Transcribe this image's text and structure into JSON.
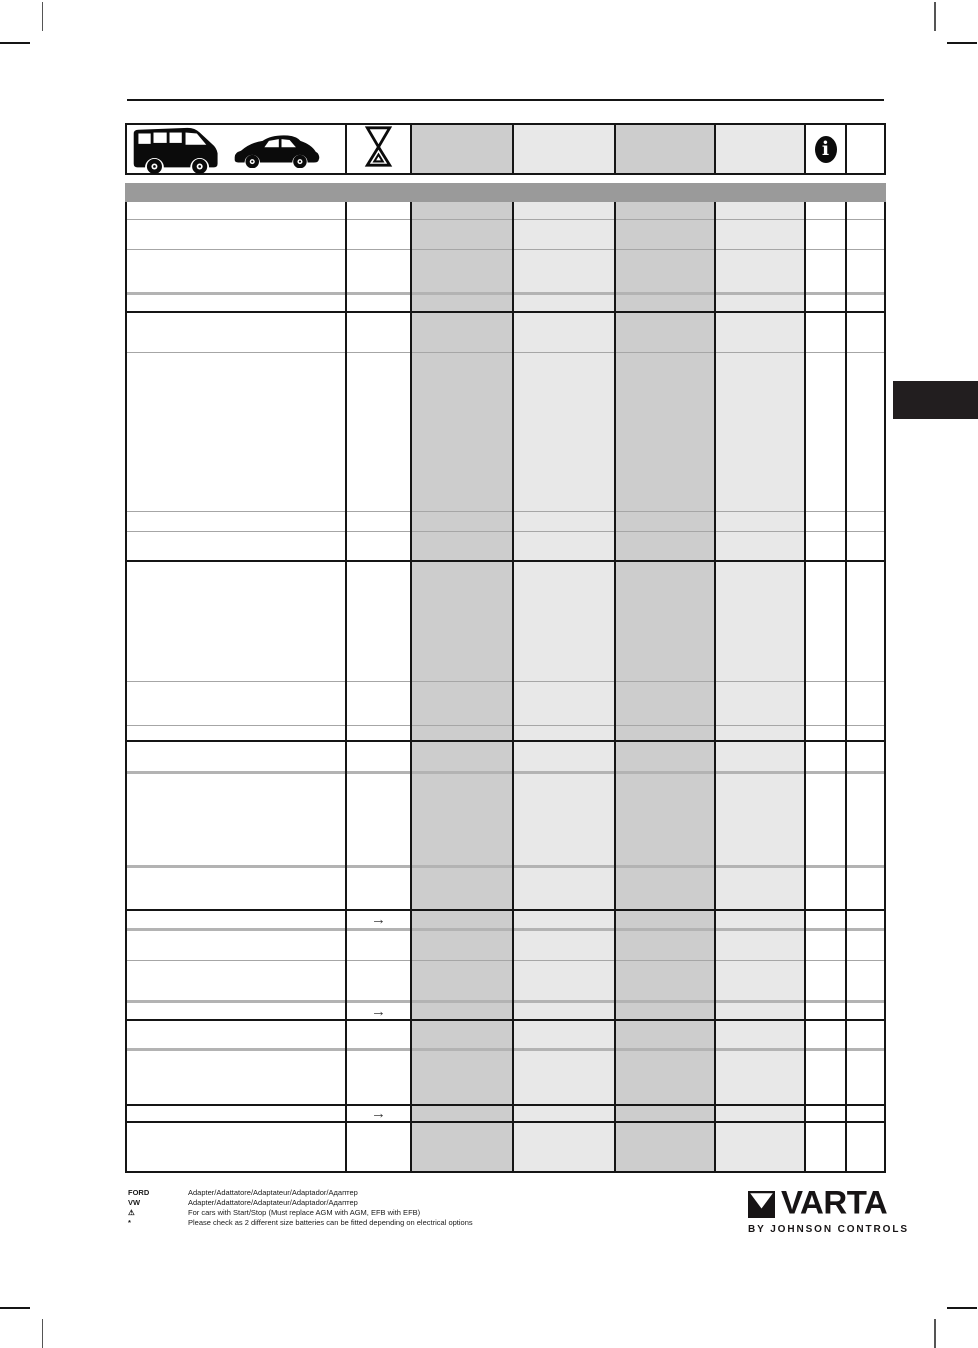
{
  "header_row": {
    "vehicle_icons": [
      "van-icon",
      "car-icon"
    ],
    "hourglass_icon": "battery-hourglass-icon",
    "info_icon_glyph": "i"
  },
  "table": {
    "arrow_glyph": "→",
    "columns": [
      {
        "key": "model",
        "width": 219,
        "shade": "white"
      },
      {
        "key": "note",
        "width": 65,
        "shade": "white"
      },
      {
        "key": "col3",
        "width": 102,
        "shade": "dark"
      },
      {
        "key": "col4",
        "width": 102,
        "shade": "light"
      },
      {
        "key": "col5",
        "width": 100,
        "shade": "dark"
      },
      {
        "key": "col6",
        "width": 90,
        "shade": "light"
      },
      {
        "key": "col7",
        "width": 41,
        "shade": "white"
      },
      {
        "key": "col8",
        "width": 38,
        "shade": "white"
      }
    ],
    "rows": [
      {
        "height": 18,
        "border_bottom": "gray",
        "arrow": false
      },
      {
        "height": 30,
        "border_bottom": "gray",
        "arrow": false
      },
      {
        "height": 45,
        "border_bottom": "thick",
        "arrow": false
      },
      {
        "height": 18,
        "border_bottom": "black",
        "arrow": false
      },
      {
        "height": 40,
        "border_bottom": "gray",
        "arrow": false
      },
      {
        "height": 159,
        "border_bottom": "gray",
        "arrow": false
      },
      {
        "height": 20,
        "border_bottom": "gray",
        "arrow": false
      },
      {
        "height": 30,
        "border_bottom": "black",
        "arrow": false
      },
      {
        "height": 120,
        "border_bottom": "gray",
        "arrow": false
      },
      {
        "height": 44,
        "border_bottom": "gray",
        "arrow": false
      },
      {
        "height": 16,
        "border_bottom": "black",
        "arrow": false
      },
      {
        "height": 32,
        "border_bottom": "thick",
        "arrow": false
      },
      {
        "height": 94,
        "border_bottom": "thick",
        "arrow": false
      },
      {
        "height": 43,
        "border_bottom": "black",
        "arrow": false
      },
      {
        "height": 20,
        "border_bottom": "thick",
        "arrow": true
      },
      {
        "height": 30,
        "border_bottom": "gray",
        "arrow": false
      },
      {
        "height": 42,
        "border_bottom": "thick",
        "arrow": false
      },
      {
        "height": 18,
        "border_bottom": "black",
        "arrow": true
      },
      {
        "height": 30,
        "border_bottom": "thick",
        "arrow": false
      },
      {
        "height": 55,
        "border_bottom": "black",
        "arrow": false
      },
      {
        "height": 17,
        "border_bottom": "black",
        "arrow": true
      },
      {
        "height": 48,
        "border_bottom": "none",
        "arrow": false
      }
    ]
  },
  "legend": {
    "items": [
      {
        "symbol": "FORD",
        "text": "Adapter/Adattatore/Adaptateur/Adaptador/Адаптер"
      },
      {
        "symbol": "VW",
        "text": "Adapter/Adattatore/Adaptateur/Adaptador/Адаптер"
      },
      {
        "symbol": "⚠",
        "text": "For cars with Start/Stop (Must replace AGM with AGM, EFB with EFB)"
      },
      {
        "symbol": "*",
        "text": "Please check as 2 different size batteries can be fitted depending on electrical options"
      }
    ]
  },
  "logo": {
    "brand": "VARTA",
    "tagline": "BY JOHNSON CONTROLS"
  },
  "colors": {
    "shade_dark": "#cdcdcd",
    "shade_light": "#e8e8e8",
    "header_band": "#9a9a9a",
    "section_tab": "#221e1f",
    "line_black": "#151515",
    "line_gray": "#a6a6a6",
    "line_thick_gray": "#b3b3b3"
  }
}
